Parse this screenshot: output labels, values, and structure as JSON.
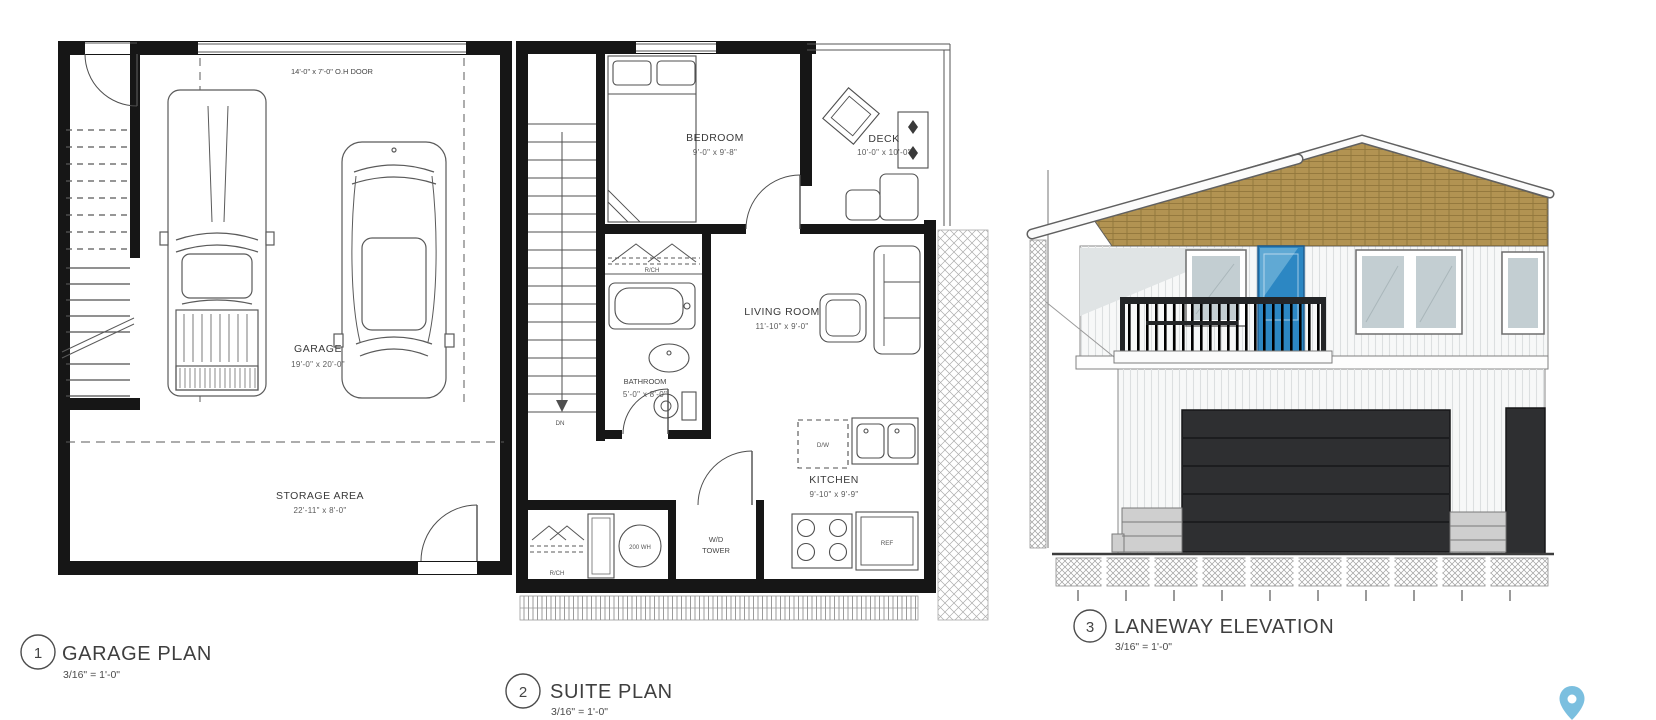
{
  "sheet": {
    "background": "#ffffff"
  },
  "garage_plan": {
    "number": "1",
    "title": "GARAGE PLAN",
    "scale": "3/16\" = 1'-0\"",
    "oh_door_label": "14'-0\" x 7'-0\" O.H DOOR",
    "garage_label": "GARAGE",
    "garage_dims": "19'-0\" x 20'-0\"",
    "storage_label": "STORAGE AREA",
    "storage_dims": "22'-11\" x 8'-0\""
  },
  "suite_plan": {
    "number": "2",
    "title": "SUITE PLAN",
    "scale": "3/16\" = 1'-0\"",
    "bedroom_label": "BEDROOM",
    "bedroom_dims": "9'-0\" x 9'-8\"",
    "deck_label": "DECK",
    "deck_dims": "10'-0\" x 10'-0\"",
    "living_label": "LIVING ROOM",
    "living_dims": "11'-10\" x 9'-0\"",
    "bathroom_label": "BATHROOM",
    "bathroom_dims": "5'-0\" x 8'-0\"",
    "kitchen_label": "KITCHEN",
    "kitchen_dims": "9'-10\" x 9'-9\"",
    "dw_label": "D/W",
    "ref_label": "REF",
    "wd_label_1": "W/D",
    "wd_label_2": "TOWER",
    "water_heater_label": "200 WH",
    "closet_label_upper": "R/CH",
    "closet_label_lower": "R/CH",
    "stair_label": "DN"
  },
  "elevation": {
    "number": "3",
    "title": "LANEWAY ELEVATION",
    "scale": "3/16\" = 1'-0\"",
    "colors": {
      "roof_shingles": "#b29352",
      "entry_door": "#2c87c3",
      "garage_door": "#2e2f31",
      "window_glass": "#c3ced2",
      "siding": "#f7f8f8",
      "railing": "#232527",
      "foundation": "#cfcfcf"
    }
  },
  "map_pin": {
    "color": "#7bbfdf"
  }
}
